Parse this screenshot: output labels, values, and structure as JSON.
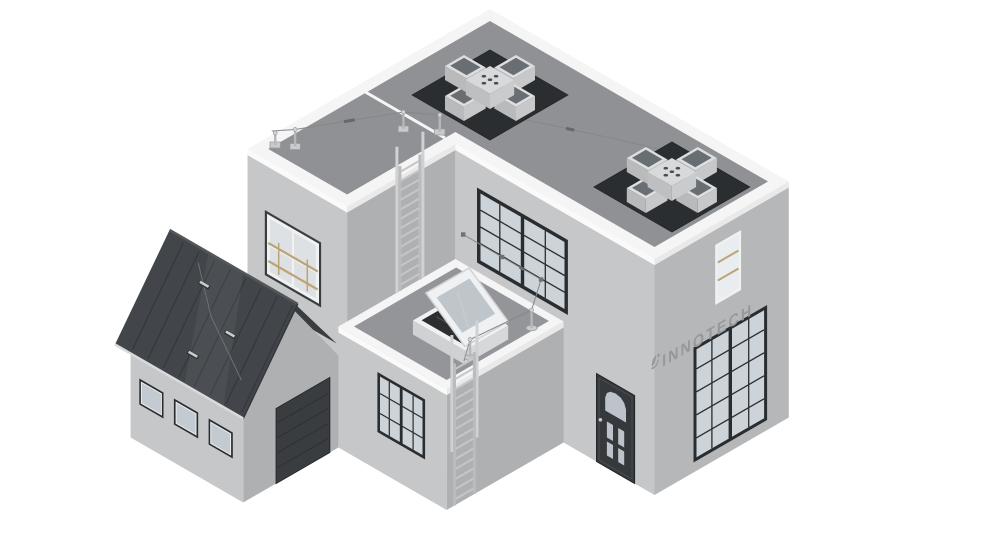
{
  "brand": {
    "name": "INNOTECH"
  },
  "scene": {
    "type": "isometric-architectural-render",
    "description": "3D isometric rendering of a modern two-storey flat-roof building with attached pitched-roof garage, rooftop cross skylights, roof hatch and fall-protection safety equipment",
    "components": [
      {
        "name": "cross-skylight",
        "count": 2
      },
      {
        "name": "roof-lifeline-anchor-post",
        "count": 3
      },
      {
        "name": "roof-lifeline-cable",
        "count": 1
      },
      {
        "name": "terrace-lifeline-post",
        "count": 2
      },
      {
        "name": "terrace-wall-cable-bracket",
        "count": 3
      },
      {
        "name": "roof-access-ladder",
        "count": 2
      },
      {
        "name": "roof-hatch-skylight",
        "count": 1
      },
      {
        "name": "window-with-safety-railing",
        "count": 2
      },
      {
        "name": "grid-window",
        "count": 4
      },
      {
        "name": "garage-window",
        "count": 3
      },
      {
        "name": "entry-door",
        "count": 1
      },
      {
        "name": "garage-sectional-door",
        "count": 1
      },
      {
        "name": "garage-roof-safety-bracket",
        "count": 3
      },
      {
        "name": "innotech-logo",
        "count": 1
      }
    ]
  },
  "colors": {
    "background": "#ffffff",
    "wall_light": "#c6c7c9",
    "wall_shaded": "#aeb0b2",
    "wall_right": "#b6b7b9",
    "parapet_top": "#f5f5f5",
    "parapet_side_light": "#fafafa",
    "parapet_side_shade": "#e9e9e9",
    "roof": "#8f9194",
    "terrace": "#939599",
    "skylight_pad": "#2b2e30",
    "skylight_frame": "#dcdedf",
    "skylight_glass": "#555b60",
    "window_frame": "#2a2d30",
    "window_glass": "#ccd3d9",
    "white_frame": "#f0f1f2",
    "railing": "#bda478",
    "entry_door": "#36393c",
    "garage_door": "#3a3d40",
    "garage_roof": "#42464a",
    "garage_roof_shaded": "#393d40",
    "garage_seam": "#34373b",
    "ridge": "#54575a",
    "gutter": "#d9dadb",
    "cable": "#85878a",
    "hardware": "#c9cbcd",
    "hardware_dark": "#6f7174",
    "logo": "#97989a"
  }
}
